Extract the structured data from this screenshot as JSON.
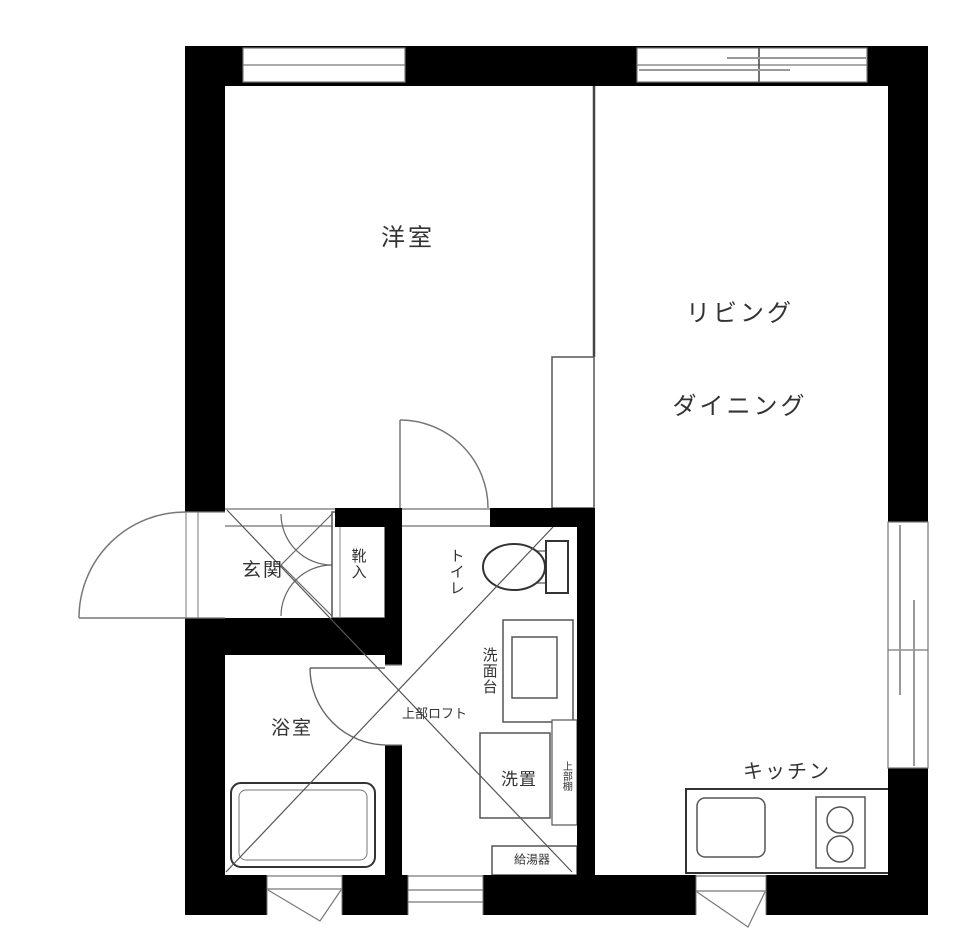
{
  "floorplan": {
    "type": "japanese-apartment-floor-plan",
    "rooms": {
      "western_room": "洋室",
      "living_line1": "リビング",
      "living_line2": "ダイニング",
      "entrance": "玄関",
      "shoe_storage": "靴入",
      "toilet": "トイレ",
      "washstand": "洗面台",
      "laundry_space": "洗置",
      "upper_shelf": "上部棚",
      "upper_loft": "上部ロフト",
      "water_heater": "給湯器",
      "bathroom": "浴室",
      "kitchen": "キッチン"
    },
    "colors": {
      "wall": "#000000",
      "line": "#555555",
      "light_line": "#888888",
      "text": "#333333",
      "background": "#ffffff"
    }
  }
}
